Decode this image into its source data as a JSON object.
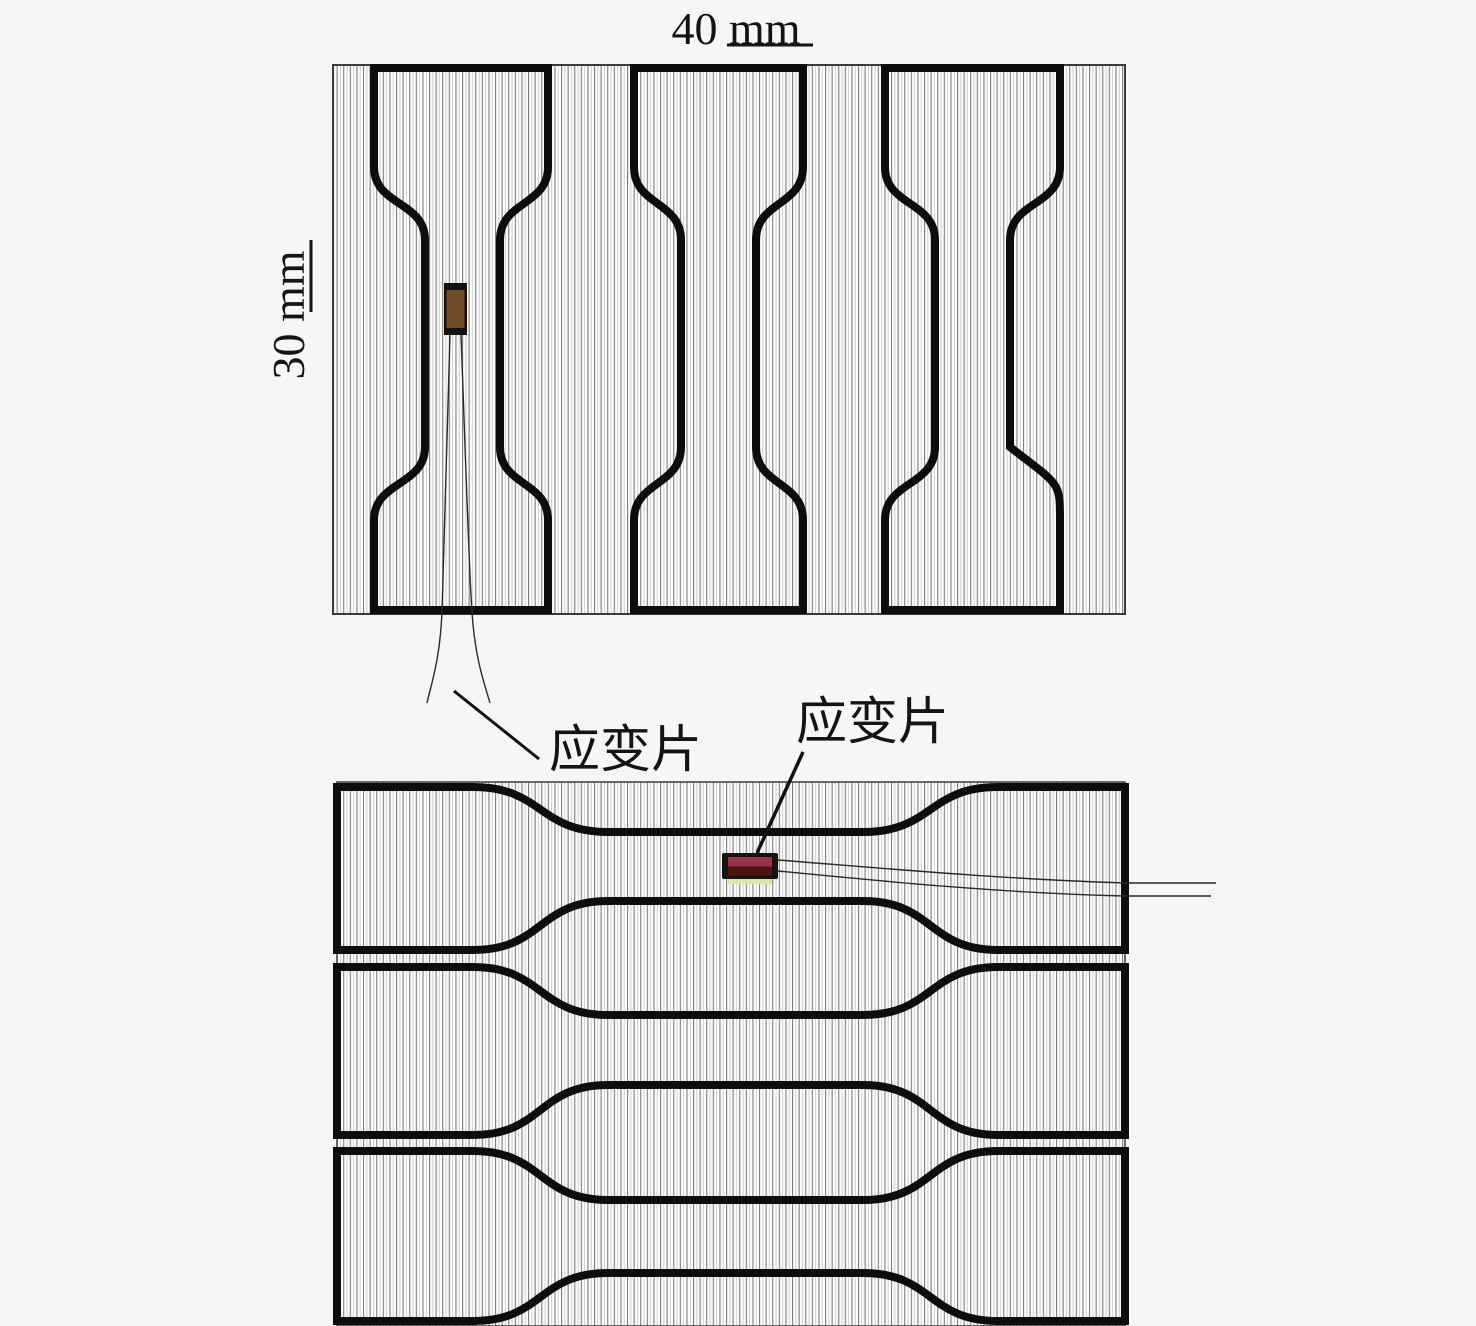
{
  "figure": {
    "top_panel": {
      "width_dimension": "40 mm",
      "height_dimension": "30 mm",
      "gauge_label": "应变片",
      "specimen_count": 3,
      "specimen_orientation": "vertical"
    },
    "bottom_panel": {
      "gauge_label": "应变片",
      "specimen_count": 3,
      "specimen_orientation": "horizontal"
    }
  },
  "colors": {
    "background": "#f6f6f4",
    "plate_fill": "#fcfcfb",
    "outline": "#0d0d0d",
    "plate_edge": "#3a3a3a",
    "wire": "#2a2a2a",
    "callout": "#111111",
    "text": "#141414",
    "gauge1_frame": "#141210",
    "gauge1_fill": "#6F4B27",
    "gauge2_frame": "#161311",
    "gauge2_fill_top": "#96324d",
    "gauge2_fill_bottom": "#4e150b",
    "gauge2_backing": "#dce6a8"
  }
}
